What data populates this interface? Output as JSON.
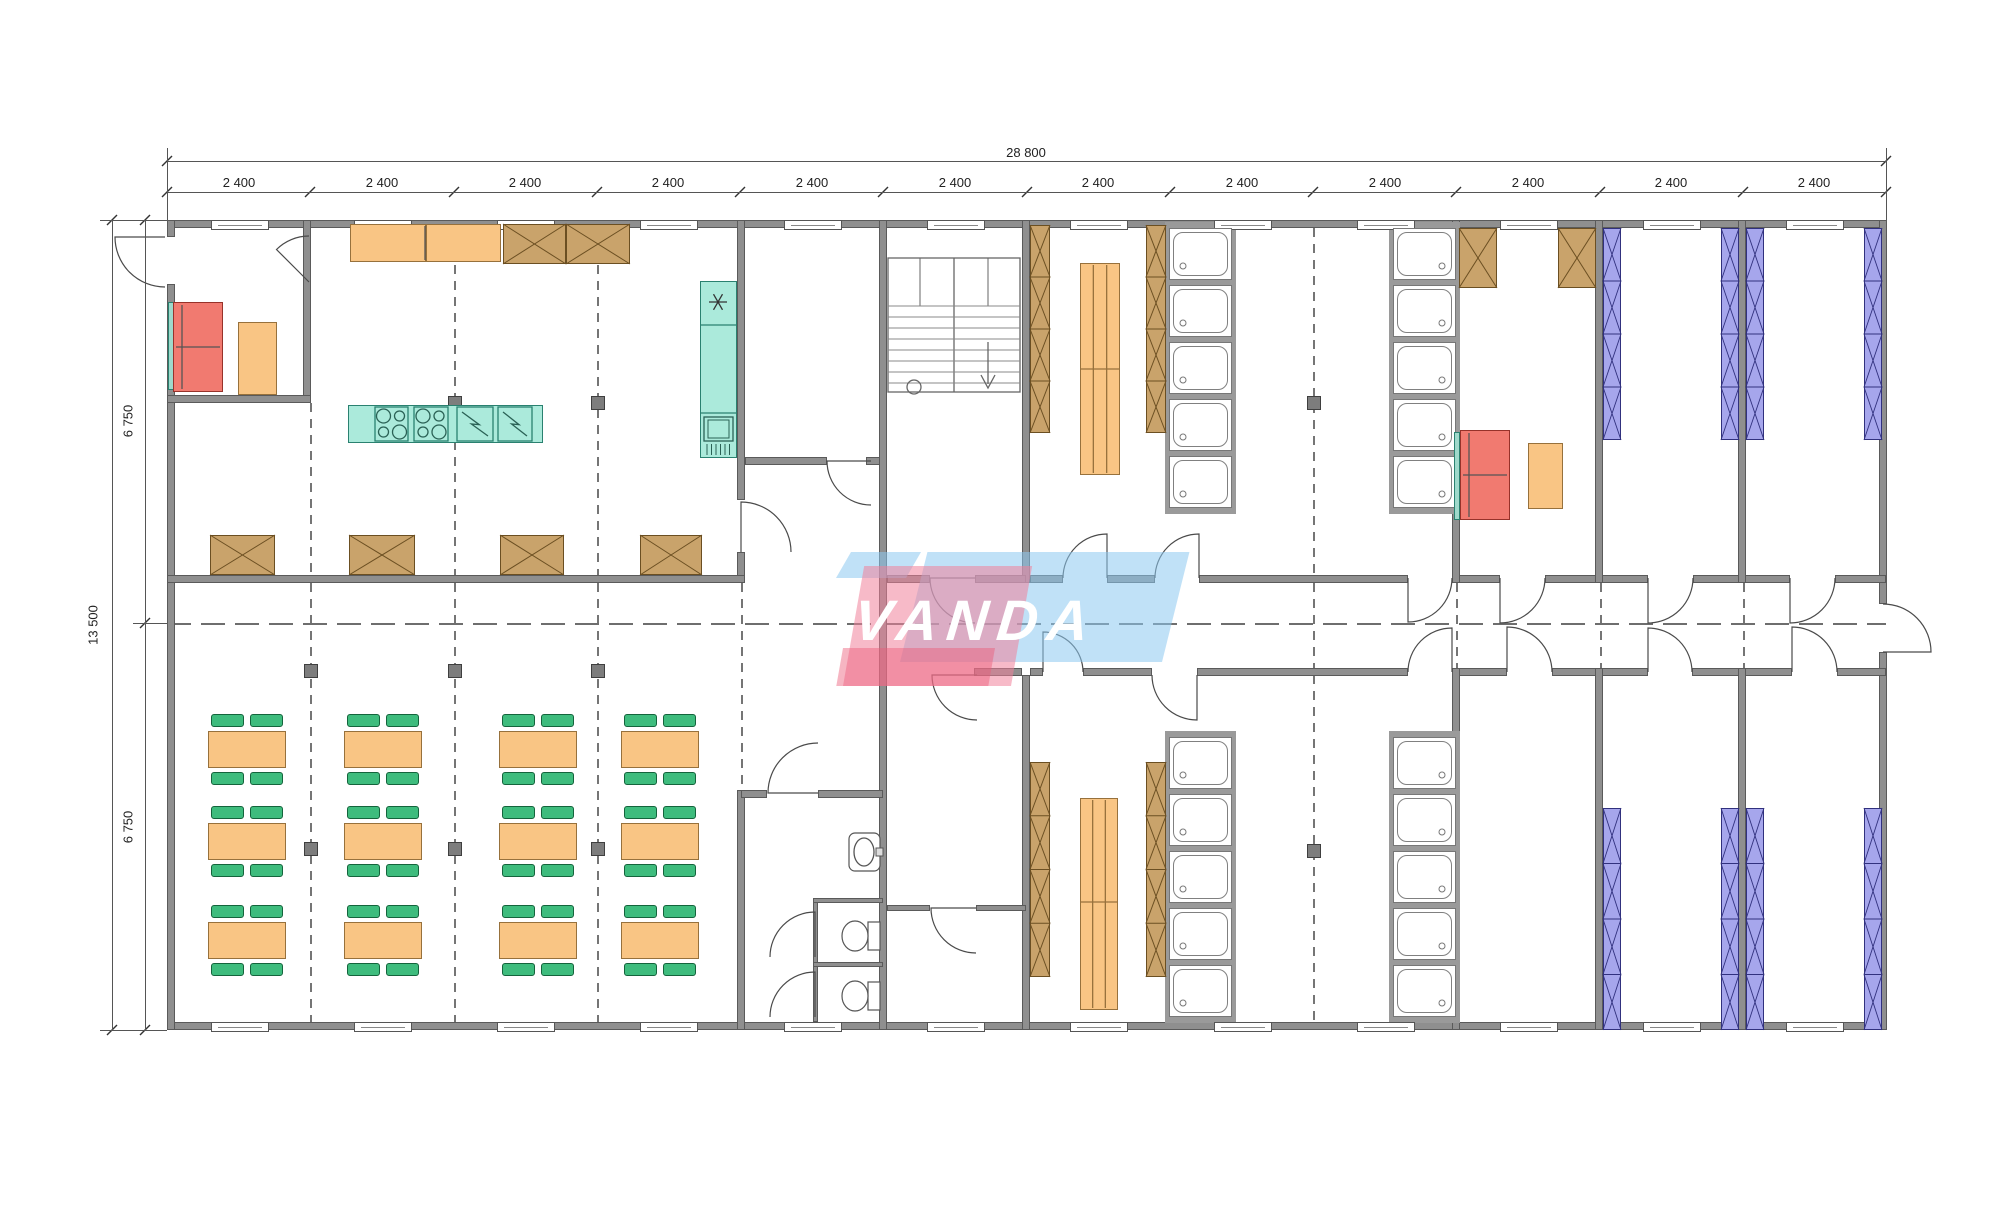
{
  "labels": {
    "total_width": "28 800",
    "module": "2 400",
    "total_height": "13 500",
    "half_height": "6 750",
    "watermark": "VANDA"
  },
  "colors": {
    "wall": "#8f8f8f",
    "wall_edge": "#5a5a5a",
    "line": "#555555",
    "orange": "#F9C584",
    "green": "#3EBC7D",
    "teal": "#ABEADB",
    "red": "#F17A70",
    "brown": "#C9A36B",
    "purple": "#A6A6EC",
    "logo_blue": "#8cc8f0",
    "logo_pink": "#f0829b"
  },
  "plan": {
    "canvas": [
      2000,
      1216
    ],
    "grid_x": [
      167,
      310,
      454,
      597,
      740,
      883,
      1027,
      1170,
      1313,
      1456,
      1600,
      1743,
      1886
    ],
    "dim": {
      "top_line1_y": 161,
      "top_line2_y": 192,
      "left_line1_x": 112,
      "left_line2_x": 145,
      "span_x": [
        167,
        1886
      ],
      "span_y": [
        220,
        1030
      ],
      "mid_y": 623,
      "module_centers": [
        239,
        382,
        525,
        668,
        812,
        955,
        1098,
        1242,
        1385,
        1528,
        1671,
        1814
      ]
    },
    "walls": [
      [
        167,
        220,
        1719,
        8
      ],
      [
        167,
        1022,
        1719,
        8
      ],
      [
        167,
        220,
        8,
        17
      ],
      [
        167,
        284,
        8,
        746
      ],
      [
        1879,
        220,
        8,
        384
      ],
      [
        1879,
        652,
        8,
        378
      ],
      [
        303,
        220,
        8,
        183
      ],
      [
        167,
        395,
        144,
        8
      ],
      [
        737,
        220,
        8,
        280
      ],
      [
        737,
        552,
        8,
        31
      ],
      [
        737,
        790,
        8,
        240
      ],
      [
        167,
        575,
        578,
        8
      ],
      [
        745,
        457,
        82,
        8
      ],
      [
        866,
        457,
        17,
        8
      ],
      [
        879,
        220,
        8,
        810
      ],
      [
        1022,
        220,
        8,
        363
      ],
      [
        1022,
        675,
        8,
        355
      ],
      [
        741,
        790,
        26,
        8
      ],
      [
        818,
        790,
        65,
        8
      ],
      [
        887,
        905,
        43,
        6
      ],
      [
        976,
        905,
        50,
        6
      ],
      [
        813,
        898,
        5,
        124
      ],
      [
        813,
        898,
        70,
        5
      ],
      [
        813,
        962,
        70,
        5
      ],
      [
        887,
        575,
        43,
        8
      ],
      [
        975,
        575,
        51,
        8
      ],
      [
        1030,
        575,
        33,
        8
      ],
      [
        1107,
        575,
        48,
        8
      ],
      [
        1199,
        575,
        209,
        8
      ],
      [
        1452,
        575,
        48,
        8
      ],
      [
        1545,
        575,
        103,
        8
      ],
      [
        1693,
        575,
        97,
        8
      ],
      [
        1835,
        575,
        51,
        8
      ],
      [
        974,
        668,
        48,
        8
      ],
      [
        1030,
        668,
        13,
        8
      ],
      [
        1083,
        668,
        69,
        8
      ],
      [
        1197,
        668,
        211,
        8
      ],
      [
        1452,
        668,
        55,
        8
      ],
      [
        1552,
        668,
        96,
        8
      ],
      [
        1692,
        668,
        100,
        8
      ],
      [
        1837,
        668,
        49,
        8
      ],
      [
        1452,
        220,
        8,
        363
      ],
      [
        1452,
        668,
        8,
        362
      ],
      [
        1595,
        220,
        8,
        363
      ],
      [
        1595,
        668,
        8,
        362
      ],
      [
        1738,
        220,
        8,
        363
      ],
      [
        1738,
        668,
        8,
        362
      ]
    ],
    "windows_top_y": 220,
    "windows_bottom_y": 1022,
    "window_w": 56,
    "window_h": 8,
    "dash_v": [
      [
        454,
        265,
        575
      ],
      [
        597,
        265,
        575
      ],
      [
        310,
        403,
        575
      ],
      [
        310,
        583,
        1022
      ],
      [
        454,
        583,
        1022
      ],
      [
        597,
        583,
        1022
      ],
      [
        741,
        583,
        790
      ],
      [
        1313,
        228,
        575
      ],
      [
        1313,
        583,
        668
      ],
      [
        1313,
        675,
        1022
      ],
      [
        1456,
        583,
        668
      ],
      [
        1600,
        583,
        668
      ],
      [
        1743,
        583,
        668
      ]
    ],
    "dash_h": [
      [
        167,
        1886,
        623
      ]
    ],
    "columns": [
      [
        454,
        402
      ],
      [
        597,
        402
      ],
      [
        1313,
        402
      ],
      [
        310,
        670
      ],
      [
        454,
        670
      ],
      [
        597,
        670
      ],
      [
        310,
        848
      ],
      [
        454,
        848
      ],
      [
        597,
        848
      ],
      [
        1313,
        850
      ]
    ],
    "boxes": {
      "orange": [
        [
          350,
          224,
          76,
          38
        ],
        [
          426,
          224,
          75,
          38
        ],
        [
          238,
          322,
          39,
          73
        ],
        [
          1528,
          443,
          35,
          66
        ]
      ],
      "teal": [
        [
          348,
          405,
          195,
          38
        ],
        [
          700,
          281,
          37,
          177
        ]
      ],
      "tealthin": [
        [
          168,
          302,
          6,
          88
        ],
        [
          1454,
          432,
          6,
          88
        ]
      ],
      "red": [
        [
          173,
          302,
          50,
          90
        ],
        [
          1460,
          430,
          50,
          90
        ]
      ]
    },
    "island_subs": [
      [
        375,
        407,
        33,
        34
      ],
      [
        414,
        407,
        34,
        34
      ],
      [
        457,
        407,
        36,
        34
      ],
      [
        498,
        407,
        34,
        34
      ]
    ],
    "cooktops": [
      [
        375,
        407,
        33,
        34
      ],
      [
        414,
        407,
        34,
        34
      ]
    ],
    "zigzags": [
      [
        457,
        407,
        36,
        34
      ],
      [
        498,
        407,
        34,
        34
      ]
    ],
    "xboxes": [
      [
        503,
        224,
        63,
        40,
        1
      ],
      [
        566,
        224,
        64,
        40,
        1
      ],
      [
        210,
        535,
        65,
        40,
        1
      ],
      [
        349,
        535,
        66,
        40,
        1
      ],
      [
        500,
        535,
        64,
        40,
        1
      ],
      [
        640,
        535,
        62,
        40,
        1
      ],
      [
        1459,
        228,
        38,
        60,
        1
      ],
      [
        1558,
        228,
        38,
        60,
        1
      ],
      [
        1030,
        225,
        20,
        208,
        4
      ],
      [
        1146,
        225,
        20,
        208,
        4
      ],
      [
        1030,
        762,
        20,
        215,
        4
      ],
      [
        1146,
        762,
        20,
        215,
        4
      ]
    ],
    "bunks": [
      [
        1603,
        228,
        18,
        212
      ],
      [
        1721,
        228,
        18,
        212
      ],
      [
        1746,
        228,
        18,
        212
      ],
      [
        1864,
        228,
        18,
        212
      ],
      [
        1603,
        808,
        18,
        222
      ],
      [
        1721,
        808,
        18,
        222
      ],
      [
        1746,
        808,
        18,
        222
      ],
      [
        1864,
        808,
        18,
        222
      ]
    ],
    "benches": [
      [
        1080,
        263,
        40,
        212,
        369
      ],
      [
        1080,
        798,
        38,
        212,
        902
      ]
    ],
    "showers": {
      "w": 63,
      "h": 52,
      "pitch": 57,
      "n": 5,
      "cols": [
        [
          1169,
          228,
          1
        ],
        [
          1393,
          228,
          -1
        ],
        [
          1169,
          737,
          1
        ],
        [
          1393,
          737,
          -1
        ]
      ]
    },
    "dining": {
      "cols": [
        247,
        383,
        538,
        660
      ],
      "rows": [
        749,
        841,
        940
      ],
      "table": [
        78,
        37
      ],
      "chair": [
        33,
        13
      ]
    },
    "doors": [
      [
        165,
        237,
        50,
        180,
        90
      ],
      [
        309,
        282,
        46,
        225,
        270
      ],
      [
        741,
        552,
        50,
        270,
        0
      ],
      [
        871,
        461,
        44,
        180,
        90
      ],
      [
        818,
        793,
        50,
        180,
        270
      ],
      [
        975,
        578,
        45,
        180,
        90
      ],
      [
        977,
        675,
        45,
        180,
        90
      ],
      [
        976,
        908,
        45,
        180,
        90
      ],
      [
        815,
        957,
        45,
        270,
        180
      ],
      [
        815,
        1017,
        45,
        270,
        180
      ],
      [
        1107,
        578,
        44,
        270,
        180
      ],
      [
        1199,
        578,
        44,
        270,
        180
      ],
      [
        1408,
        578,
        44,
        90,
        0
      ],
      [
        1500,
        578,
        45,
        90,
        0
      ],
      [
        1648,
        578,
        45,
        90,
        0
      ],
      [
        1790,
        578,
        45,
        90,
        0
      ],
      [
        1043,
        672,
        40,
        270,
        0
      ],
      [
        1197,
        675,
        45,
        90,
        180
      ],
      [
        1452,
        672,
        44,
        270,
        180
      ],
      [
        1507,
        672,
        45,
        270,
        0
      ],
      [
        1648,
        672,
        44,
        270,
        0
      ],
      [
        1792,
        672,
        45,
        270,
        0
      ],
      [
        1883,
        652,
        48,
        0,
        270
      ]
    ],
    "stairs": {
      "box": [
        888,
        258,
        132,
        134
      ],
      "well": [
        920,
        258,
        68,
        48
      ],
      "div_x": 954,
      "tread_y0": 306,
      "tread_step": 11,
      "tread_n": 8,
      "circle": [
        914,
        387,
        7
      ],
      "arrow": [
        988,
        342,
        988,
        384
      ]
    },
    "fixtures": {
      "toilets": [
        [
          855,
          936
        ],
        [
          855,
          996
        ]
      ],
      "basin": [
        864,
        852
      ],
      "star": [
        718,
        302
      ],
      "sink_box": [
        704,
        417,
        29,
        24
      ],
      "tall_unit_lines": [
        325,
        413
      ],
      "counter_div_x": 425
    },
    "logo": {
      "blue_main": [
        900,
        552,
        262,
        110
      ],
      "blue_corner": [
        836,
        552,
        70,
        26
      ],
      "pink_main": [
        843,
        566,
        168,
        120
      ],
      "red_under": [
        843,
        648,
        152,
        38
      ],
      "text_pos": [
        854,
        588
      ]
    }
  }
}
